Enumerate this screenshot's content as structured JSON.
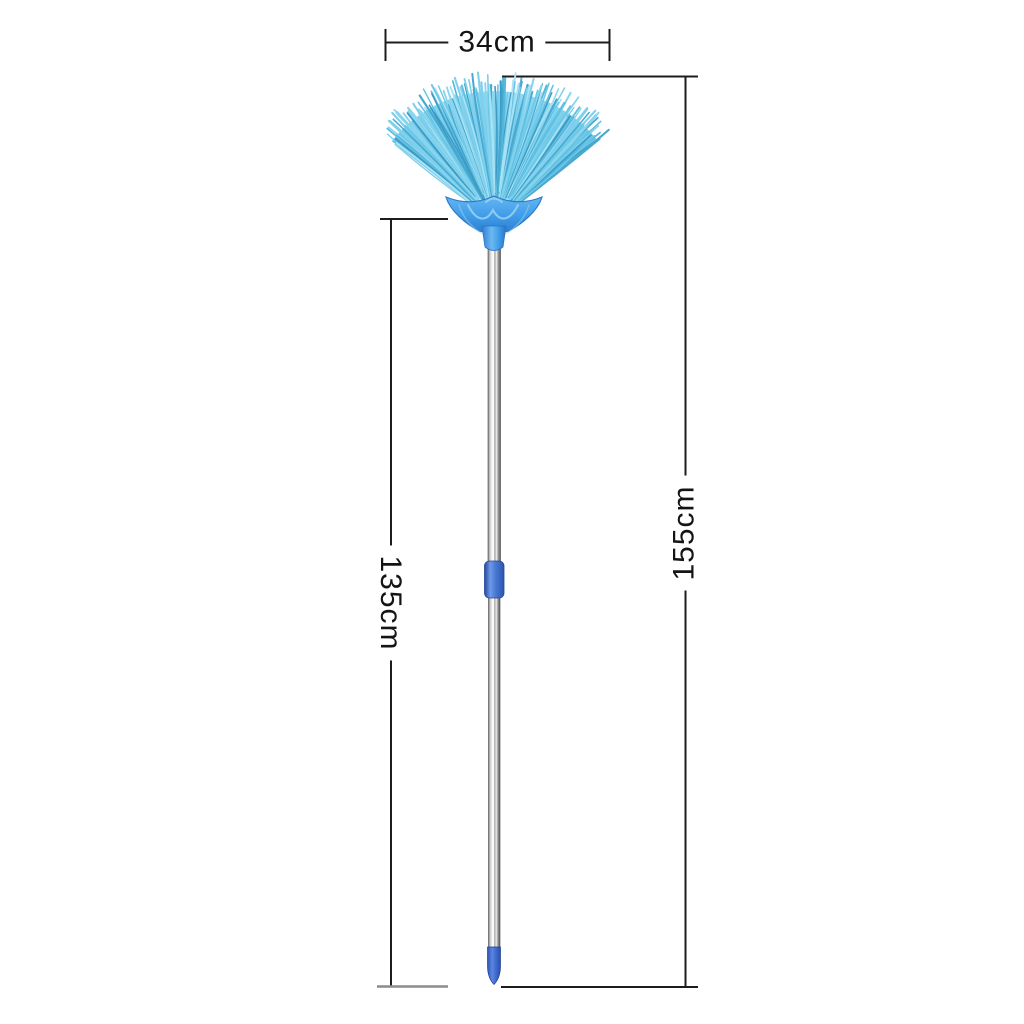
{
  "page": {
    "background": "#ffffff"
  },
  "product": {
    "name": "telescopic-fan-broom",
    "dimensions": {
      "width_label": "34cm",
      "total_height_label": "155cm",
      "handle_height_label": "135cm"
    }
  },
  "colors": {
    "label_text": "#141414",
    "dimension_line": "#1c1c1c",
    "dimension_line_secondary": "#8c8c8c",
    "bristle_palette": [
      "#55b8dc",
      "#6cc9e8",
      "#8ad5ee",
      "#48a8d0",
      "#a9e2f3",
      "#5fc0e4",
      "#3d9cc6",
      "#7fd0ec"
    ],
    "fan_fill_top": "#95dbf1",
    "fan_fill_bottom": "#4aa9d1",
    "head_top": "#66b6f2",
    "head_mid": "#409de8",
    "head_bottom": "#2e80d2",
    "head_outline": "#2b7cc8",
    "head_decor": "#9ad4f6",
    "socket_light": "#6cb8f2",
    "collar_light": "#6f9ae8",
    "collar": "#4a7ad4",
    "collar_edge": "#24479c",
    "cap_light": "#5d86e2",
    "cap": "#3f6ad0",
    "cap_edge": "#1f3f96",
    "pole_edge": "#606060",
    "pole_light": "#ffffff"
  }
}
